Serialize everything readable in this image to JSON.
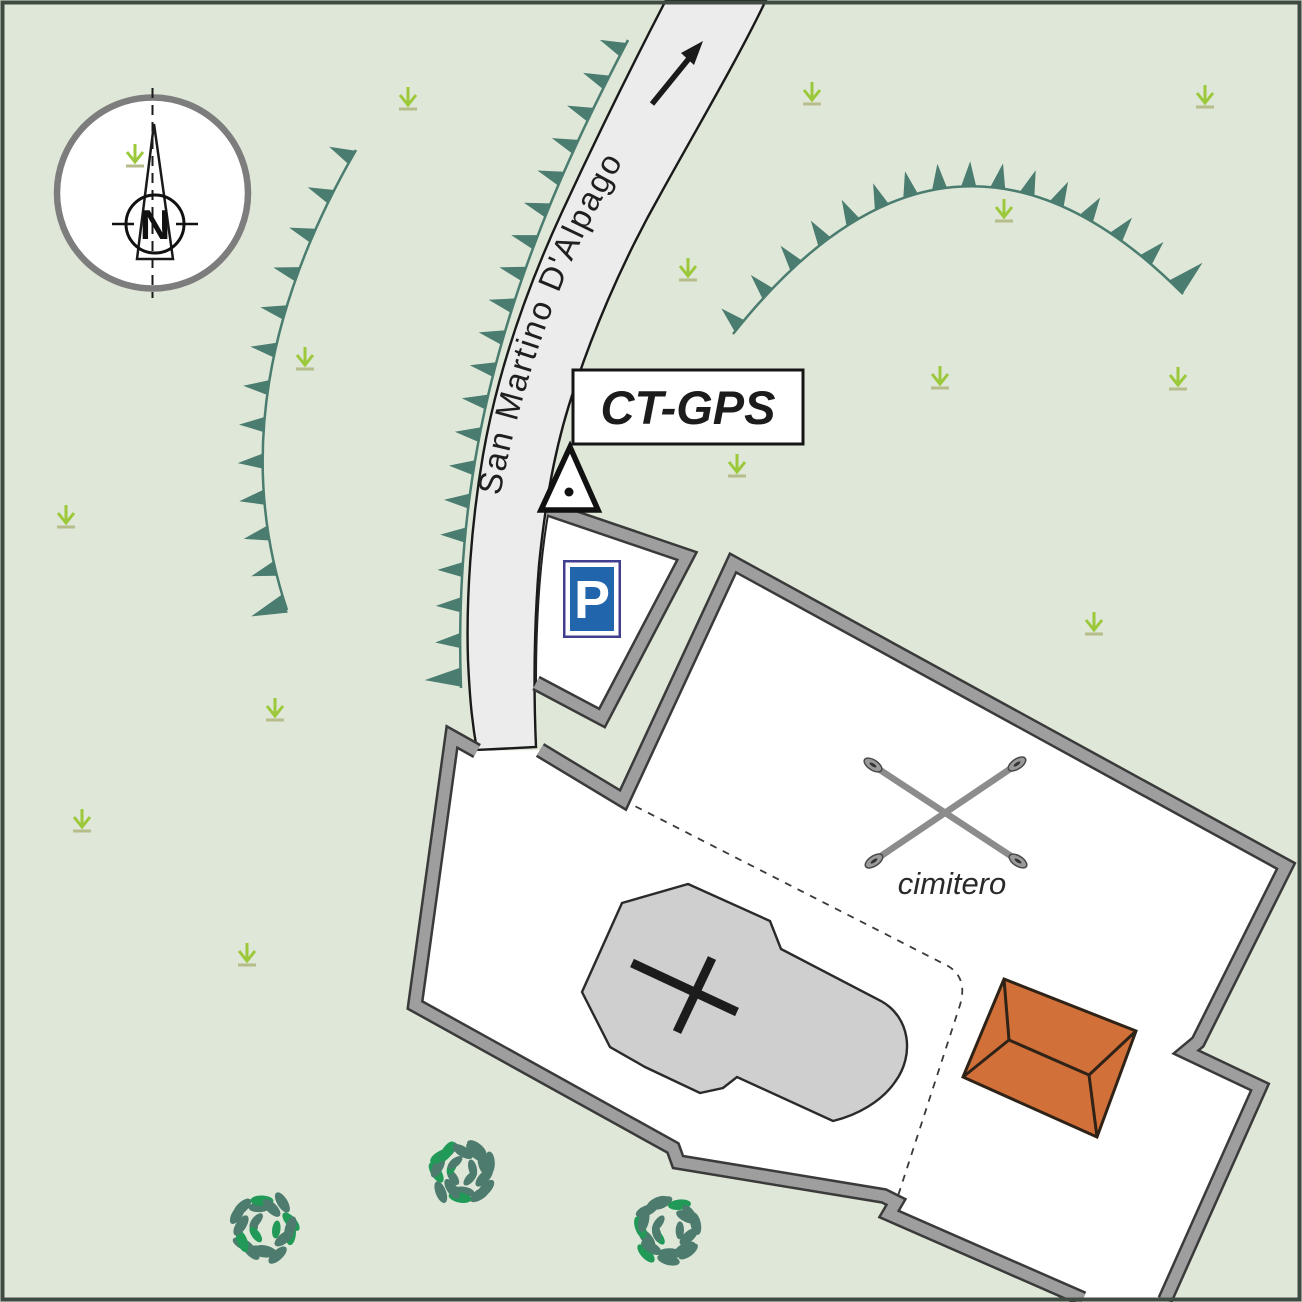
{
  "labels": {
    "road": "San Martino D'Alpago",
    "station": "CT-GPS",
    "cemetery": "cimitero",
    "compass_north": "N",
    "parking": "P"
  },
  "colors": {
    "background": "#dfe8d8",
    "frame": "#3f4a42",
    "road_fill": "#ececec",
    "road_edge": "#1a1a1a",
    "wall_fill": "#9e9e9e",
    "wall_edge": "#3a3a3a",
    "area_white": "#ffffff",
    "church_fill": "#cfcfcf",
    "church_edge": "#2a2a2a",
    "cross_dark": "#1c1c1c",
    "building_fill": "#d2703a",
    "building_edge": "#2f2318",
    "hedge": "#4a7c6f",
    "grass": "#9cc93b",
    "grass_base": "#b7bd8a",
    "tree_leaf": "#4d7b6e",
    "tree_accent": "#219a58",
    "marker_edge": "#111111",
    "dashed_line": "#3a3a3a",
    "x_gray": "#8c8c8c",
    "x_dark": "#474747",
    "parking_blue": "#2166ad",
    "parking_border": "#413d8f",
    "compass_ring": "#7d7d7d"
  },
  "decorations": {
    "grass": [
      [
        408,
        100
      ],
      [
        135,
        157
      ],
      [
        812,
        95
      ],
      [
        1205,
        98
      ],
      [
        688,
        271
      ],
      [
        1004,
        212
      ],
      [
        940,
        379
      ],
      [
        1178,
        380
      ],
      [
        737,
        467
      ],
      [
        305,
        360
      ],
      [
        66,
        518
      ],
      [
        275,
        711
      ],
      [
        82,
        822
      ],
      [
        247,
        956
      ],
      [
        1094,
        625
      ]
    ],
    "trees": [
      {
        "x": 265,
        "y": 1228,
        "r": 27,
        "seed": 3
      },
      {
        "x": 462,
        "y": 1171,
        "r": 26,
        "seed": 11
      },
      {
        "x": 668,
        "y": 1230,
        "r": 28,
        "seed": 23
      }
    ],
    "hedges": [
      {
        "kind": "quad",
        "pts": [
          356,
          150,
          215,
          395,
          287,
          610
        ],
        "spikes": 13,
        "side": 1
      },
      {
        "kind": "cubic",
        "pts": [
          628,
          40,
          515,
          255,
          452,
          445,
          461,
          688
        ],
        "spikes": 20,
        "side": 1
      },
      {
        "kind": "quad",
        "pts": [
          733,
          334,
          950,
          60,
          1183,
          294
        ],
        "spikes": 16,
        "side": -1
      }
    ]
  }
}
